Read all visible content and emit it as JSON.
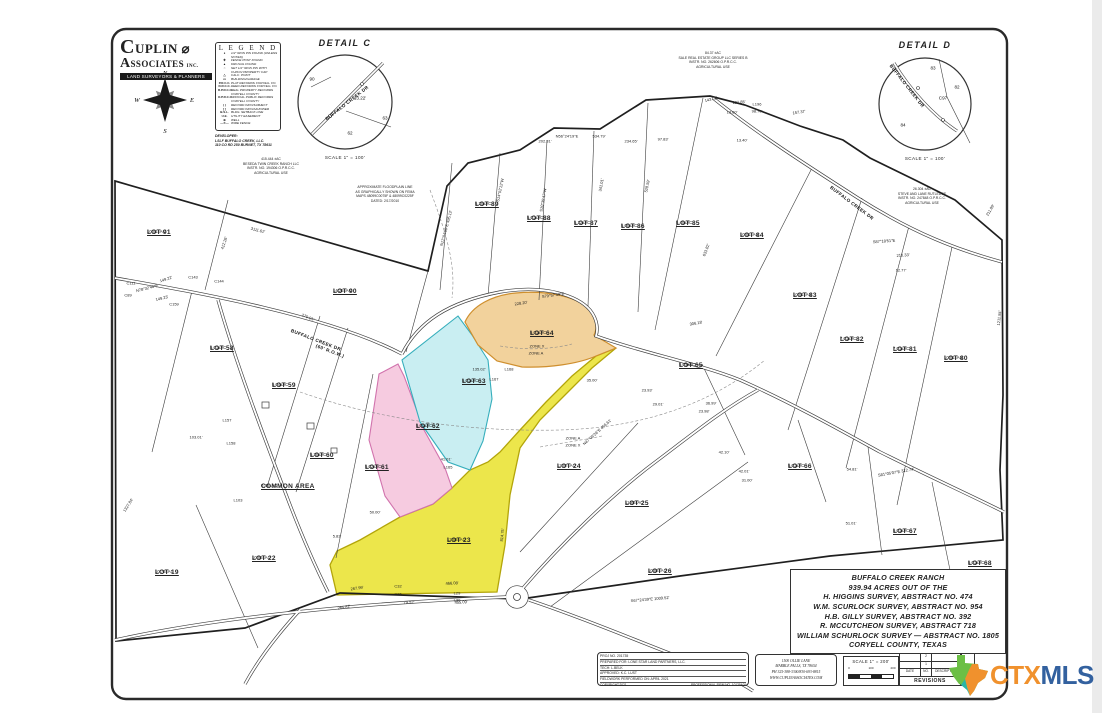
{
  "branding": {
    "name_top": "CUPLIN",
    "name_mid": "ASSOCIATES",
    "name_inc": "INC.",
    "banner": "LAND SURVEYORS & PLANNERS"
  },
  "compass": {
    "n": "N",
    "e": "E",
    "s": "S",
    "w": "W"
  },
  "legend": {
    "title": "L E G E N D",
    "items": [
      {
        "sym": "●",
        "text": "1/2\" IRON PIN FOUND (UNLESS NOTED)"
      },
      {
        "sym": "✚",
        "text": "FENCE POST FOUND"
      },
      {
        "sym": "▲",
        "text": "60D NAIL FOUND"
      },
      {
        "sym": "○",
        "text": "SET 1/2\" IRON PIN WITH CUPLIN PROPERTY CAP"
      },
      {
        "sym": "△",
        "text": "CALC. POINT"
      },
      {
        "sym": "▭",
        "text": "BUILDING/GARAGE"
      },
      {
        "sym": "P.R.C.C.",
        "text": "PLAT RECORDS CORYELL CO."
      },
      {
        "sym": "D.R.C.C.",
        "text": "DEED RECORDS CORYELL CO."
      },
      {
        "sym": "R.P.R.C.C.",
        "text": "REAL PROPERTY RECORDS CORYELL COUNTY"
      },
      {
        "sym": "O.P.R.C.C.",
        "text": "OFFICIAL PUBLIC RECORDS CORYELL COUNTY"
      },
      {
        "sym": "( )",
        "text": "RECORD INFO/SUBJECT"
      },
      {
        "sym": "[ ]",
        "text": "RECORD INFO/ADJOINER"
      },
      {
        "sym": "B.S.L.",
        "text": "BLDG. SETBACK LINE"
      },
      {
        "sym": "U.E.",
        "text": "UTILITY EASEMENT"
      },
      {
        "sym": "⊕",
        "text": "WELL"
      },
      {
        "sym": "—✕—",
        "text": "WIRE FENCE"
      }
    ]
  },
  "developer": {
    "lines": [
      "DEVELOPER:",
      "LSLF BUFFALO CREEK, LLC.",
      "110 CO RD 250 BURNET, TX 78611"
    ]
  },
  "notes": {
    "beseda": [
      "415.444  ±AC",
      "BESEDA TWIN CREEK RANCH LLC",
      "INSTR. NO. 194306 O.P.R.C.C.",
      "AGRICULTURAL USE"
    ],
    "floodplain": [
      "APPROXIMATE FLOODPLAIN LINE",
      "AS GRAPHICALLY SHOWN ON FEMA",
      "MAPS 48099C0075F & 48099C0225F",
      "DATED: 2/17/2010"
    ],
    "sale": [
      "84.37  ±AC",
      "SALE REAL ESTATE GROUP LLC SERIES B",
      "INSTR. NO. 262606 O.P.R.C.C.",
      "AGRICULTURAL USE"
    ],
    "rutledge": [
      "26.304  ±AC",
      "STEVE AND LANE RUTLEDGE",
      "INSTR. NO. 247848 O.P.R.C.C.",
      "AGRICULTURAL USE"
    ]
  },
  "detail_c": {
    "title": "DETAIL  C",
    "scale": "SCALE  1\" =  100'",
    "labels": [
      {
        "t": "90",
        "x": 312,
        "y": 79,
        "r": 0
      },
      {
        "t": "63",
        "x": 385,
        "y": 118,
        "r": 0
      },
      {
        "t": "62",
        "x": 350,
        "y": 133,
        "r": 0
      },
      {
        "t": "13.22'",
        "x": 360,
        "y": 98,
        "r": 0
      },
      {
        "t": "BUFFALO CREEK DR",
        "x": 347,
        "y": 103,
        "r": -38
      }
    ]
  },
  "detail_d": {
    "title": "DETAIL  D",
    "scale": "SCALE  1\" =  100'",
    "labels": [
      {
        "t": "83",
        "x": 933,
        "y": 68,
        "r": 0
      },
      {
        "t": "82",
        "x": 957,
        "y": 87,
        "r": 0
      },
      {
        "t": "84",
        "x": 903,
        "y": 125,
        "r": 0
      },
      {
        "t": "C97",
        "x": 943,
        "y": 98,
        "r": 0
      },
      {
        "t": "BUFFALO CREEK DR",
        "x": 907,
        "y": 86,
        "r": 52
      }
    ]
  },
  "title_block": {
    "lines": [
      "BUFFALO CREEK RANCH",
      "939.94 ACRES OUT OF THE",
      "H. HIGGINS SURVEY, ABSTRACT NO. 474",
      "W.M. SCURLOCK SURVEY, ABSTRACT NO. 954",
      "H.B. GILLY SURVEY, ABSTRACT NO. 392",
      "R. MCCUTCHEON SURVEY, ABSTRACT 718",
      "WILLIAM SCHURLOCK SURVEY — ABSTRACT NO. 1805",
      "CORYELL COUNTY, TEXAS"
    ]
  },
  "proj_box": {
    "rows": [
      "PROJ NO. 201735",
      "PREPARED FOR: LONE STAR LAND PARTNERS, LLC.",
      "TECH: L.BELK",
      "APPROVED: K.C. LUST",
      "FIELDWORK PERFORMED ON: APRIL 2021"
    ],
    "copyright": "COPYRIGHT:2021",
    "firm": "PROFESSIONAL FIRM NO. 10139400"
  },
  "address_box": {
    "lines": [
      "1500 OLLIE LANE",
      "MARBLE FALLS, TX 78654",
      "PH 325-388-3300/830-693-8815",
      "WWW.CUPLINASSOCIATES.COM"
    ]
  },
  "scale_box": {
    "label": "SCALE  1\" =  200'",
    "ticks": [
      "0",
      "100",
      "200"
    ]
  },
  "revisions": {
    "rows": [
      "2",
      "1"
    ],
    "date": "DATE",
    "no": "NO.",
    "description": "DESCRIPTION",
    "label": "REVISIONS"
  },
  "sheet_box": {
    "word": "SHEET",
    "num": "7 of"
  },
  "watermark": {
    "ctx": "CTX",
    "mls": "MLS",
    "ctx_color": "#f0912d",
    "mls_color": "#33619f",
    "texas_green": "#6cbf45",
    "texas_orange": "#f0912d",
    "texas_teal": "#2ab5a5"
  },
  "map": {
    "colors": {
      "lot23_fill": "#ece64b",
      "lot23_stroke": "#b3a50a",
      "lot62_fill": "#f6cbe0",
      "lot62_stroke": "#d173ad",
      "lot63_fill": "#c9eef2",
      "lot63_stroke": "#35aebc",
      "lot64_fill": "#f2d29c",
      "lot64_stroke": "#cf8f2e"
    },
    "lots": [
      {
        "name": "LOT 91",
        "area": "10.01±AC",
        "x": 147,
        "y": 229
      },
      {
        "name": "LOT 90",
        "area": "14.25±AC",
        "x": 333,
        "y": 288
      },
      {
        "name": "LOT 89",
        "area": "5.20±AC",
        "x": 475,
        "y": 201
      },
      {
        "name": "LOT 88",
        "area": "5.01±AC",
        "x": 527,
        "y": 215
      },
      {
        "name": "LOT 87",
        "area": "5.12±AC",
        "x": 574,
        "y": 220
      },
      {
        "name": "LOT 86",
        "area": "5.00±AC",
        "x": 621,
        "y": 223
      },
      {
        "name": "LOT 85",
        "area": "5.40±AC",
        "x": 676,
        "y": 220
      },
      {
        "name": "LOT 84",
        "area": "10.01±AC",
        "x": 740,
        "y": 232
      },
      {
        "name": "LOT 83",
        "area": "10.01±AC",
        "x": 793,
        "y": 292
      },
      {
        "name": "LOT 82",
        "area": "7.01±AC",
        "x": 840,
        "y": 336
      },
      {
        "name": "LOT 81",
        "area": "7.01±AC",
        "x": 893,
        "y": 346
      },
      {
        "name": "LOT 80",
        "area": "10.01±AC",
        "x": 944,
        "y": 355
      },
      {
        "name": "LOT 58",
        "area": "5.01±AC",
        "x": 210,
        "y": 345
      },
      {
        "name": "LOT 59",
        "area": "5.04±AC",
        "x": 272,
        "y": 382
      },
      {
        "name": "LOT 60",
        "area": "5.30±AC",
        "x": 310,
        "y": 452
      },
      {
        "name": "LOT 61",
        "area": "5.02±AC",
        "x": 365,
        "y": 464
      },
      {
        "name": "LOT 62",
        "area": "5.01±AC",
        "x": 416,
        "y": 423
      },
      {
        "name": "LOT 63",
        "area": "5.01±AC",
        "x": 462,
        "y": 378
      },
      {
        "name": "LOT 64",
        "area": "5.01±AC",
        "x": 530,
        "y": 330
      },
      {
        "name": "LOT 65",
        "area": "5.01±AC",
        "x": 679,
        "y": 362
      },
      {
        "name": "LOT 66",
        "area": "5.01±AC",
        "x": 788,
        "y": 463
      },
      {
        "name": "LOT 67",
        "area": "5.01±AC",
        "x": 893,
        "y": 528
      },
      {
        "name": "LOT 68",
        "area": "5.01±AC",
        "x": 968,
        "y": 560
      },
      {
        "name": "LOT 22",
        "area": "10.06±AC",
        "x": 252,
        "y": 555
      },
      {
        "name": "LOT 19",
        "area": "10.73±AC",
        "x": 155,
        "y": 569
      },
      {
        "name": "LOT 23",
        "area": "12.08±AC",
        "x": 447,
        "y": 537
      },
      {
        "name": "LOT 24",
        "area": "12.07±AC",
        "x": 557,
        "y": 463
      },
      {
        "name": "LOT 25",
        "area": "11.80±AC",
        "x": 625,
        "y": 500
      },
      {
        "name": "LOT 26",
        "area": "10.02±AC",
        "x": 648,
        "y": 568
      },
      {
        "name": "COMMON AREA",
        "area": "0.80±AC",
        "x": 261,
        "y": 483
      }
    ],
    "road_names": [
      {
        "t": "BUFFALO CREEK DR",
        "x": 316,
        "y": 340,
        "r": 21
      },
      {
        "t": "(60' R.O.W.)",
        "x": 330,
        "y": 351,
        "r": 21
      },
      {
        "t": "BUFFALO CREEK DR",
        "x": 852,
        "y": 203,
        "r": 37
      }
    ],
    "measurements": [
      {
        "t": "3111.62'",
        "x": 258,
        "y": 230,
        "r": 14
      },
      {
        "t": "N17°04'50\"E  495.12'",
        "x": 446,
        "y": 228,
        "r": -75
      },
      {
        "t": "412.26'",
        "x": 224,
        "y": 243,
        "r": -72
      },
      {
        "t": "149.22'",
        "x": 166,
        "y": 279,
        "r": -18
      },
      {
        "t": "N78°32'40\"E",
        "x": 147,
        "y": 288,
        "r": -14
      },
      {
        "t": "149.23'",
        "x": 162,
        "y": 298,
        "r": -14
      },
      {
        "t": "C143",
        "x": 193,
        "y": 277,
        "r": 0
      },
      {
        "t": "C144",
        "x": 219,
        "y": 281,
        "r": 0
      },
      {
        "t": "C159",
        "x": 174,
        "y": 304,
        "r": 0
      },
      {
        "t": "C111",
        "x": 131,
        "y": 283,
        "r": 0
      },
      {
        "t": "C89",
        "x": 128,
        "y": 295,
        "r": 0
      },
      {
        "t": "103.01'",
        "x": 196,
        "y": 437,
        "r": 0
      },
      {
        "t": "L157",
        "x": 227,
        "y": 420,
        "r": 0
      },
      {
        "t": "L158",
        "x": 231,
        "y": 443,
        "r": 0
      },
      {
        "t": "L103",
        "x": 238,
        "y": 500,
        "r": 0
      },
      {
        "t": "270.01'",
        "x": 308,
        "y": 317,
        "r": 22
      },
      {
        "t": "1327.84'",
        "x": 128,
        "y": 505,
        "r": -58
      },
      {
        "t": "S14°02'12\"W",
        "x": 500,
        "y": 190,
        "r": -78
      },
      {
        "t": "S10°35'47\"W",
        "x": 543,
        "y": 200,
        "r": -80
      },
      {
        "t": "341.01'",
        "x": 601,
        "y": 185,
        "r": -80
      },
      {
        "t": "528.59'",
        "x": 647,
        "y": 186,
        "r": -78
      },
      {
        "t": "N56°24'19\"E",
        "x": 567,
        "y": 136,
        "r": 0
      },
      {
        "t": "534.79'",
        "x": 599,
        "y": 136,
        "r": 0
      },
      {
        "t": "234.65'",
        "x": 631,
        "y": 141,
        "r": 0
      },
      {
        "t": "202.31'",
        "x": 545,
        "y": 141,
        "r": 0
      },
      {
        "t": "97.83'",
        "x": 663,
        "y": 139,
        "r": 0
      },
      {
        "t": "13.40'",
        "x": 742,
        "y": 140,
        "r": 0
      },
      {
        "t": "143.02'",
        "x": 711,
        "y": 99,
        "r": -15
      },
      {
        "t": "131.85'",
        "x": 739,
        "y": 102,
        "r": -5
      },
      {
        "t": "L196",
        "x": 757,
        "y": 104,
        "r": 0
      },
      {
        "t": "98.70'",
        "x": 757,
        "y": 111,
        "r": 0
      },
      {
        "t": "157.37'",
        "x": 799,
        "y": 112,
        "r": -8
      },
      {
        "t": "13.60'",
        "x": 732,
        "y": 112,
        "r": 0
      },
      {
        "t": "S87°18'51\"E",
        "x": 884,
        "y": 241,
        "r": -4
      },
      {
        "t": "210.33'",
        "x": 903,
        "y": 255,
        "r": -4
      },
      {
        "t": "12.77'",
        "x": 901,
        "y": 270,
        "r": 0
      },
      {
        "t": "633.82'",
        "x": 706,
        "y": 250,
        "r": -70
      },
      {
        "t": "211.89'",
        "x": 990,
        "y": 210,
        "r": -60
      },
      {
        "t": "1211.84'",
        "x": 999,
        "y": 318,
        "r": -84
      },
      {
        "t": "S81°05'07\"E  312.74'",
        "x": 896,
        "y": 472,
        "r": -10
      },
      {
        "t": "51.01'",
        "x": 851,
        "y": 523,
        "r": 0
      },
      {
        "t": "54.81'",
        "x": 852,
        "y": 469,
        "r": 0
      },
      {
        "t": "306.18'",
        "x": 696,
        "y": 323,
        "r": -10
      },
      {
        "t": "23.93'",
        "x": 647,
        "y": 390,
        "r": 0
      },
      {
        "t": "29.01'",
        "x": 658,
        "y": 404,
        "r": 0
      },
      {
        "t": "36.99'",
        "x": 711,
        "y": 403,
        "r": 0
      },
      {
        "t": "23.98'",
        "x": 704,
        "y": 411,
        "r": 0
      },
      {
        "t": "42.10'",
        "x": 724,
        "y": 452,
        "r": 0
      },
      {
        "t": "42.01'",
        "x": 744,
        "y": 471,
        "r": 0
      },
      {
        "t": "31.00'",
        "x": 747,
        "y": 480,
        "r": 0
      },
      {
        "t": "35.00'",
        "x": 592,
        "y": 380,
        "r": 0
      },
      {
        "t": "135.02'",
        "x": 479,
        "y": 369,
        "r": 0
      },
      {
        "t": "L167",
        "x": 494,
        "y": 379,
        "r": 0
      },
      {
        "t": "L168",
        "x": 509,
        "y": 369,
        "r": 0
      },
      {
        "t": "228.20'",
        "x": 521,
        "y": 303,
        "r": -8
      },
      {
        "t": "S79°57'49\"E",
        "x": 553,
        "y": 295,
        "r": -8
      },
      {
        "t": "41.01'",
        "x": 446,
        "y": 459,
        "r": 0
      },
      {
        "t": "L165",
        "x": 448,
        "y": 467,
        "r": 0
      },
      {
        "t": "50.00'",
        "x": 375,
        "y": 512,
        "r": 0
      },
      {
        "t": "5.83'",
        "x": 337,
        "y": 536,
        "r": 0
      },
      {
        "t": "267.99'",
        "x": 357,
        "y": 588,
        "r": -8
      },
      {
        "t": "C32",
        "x": 398,
        "y": 586,
        "r": 0
      },
      {
        "t": "C36",
        "x": 398,
        "y": 594,
        "r": 0
      },
      {
        "t": "L29",
        "x": 457,
        "y": 593,
        "r": 0
      },
      {
        "t": "L30",
        "x": 457,
        "y": 600,
        "r": 0
      },
      {
        "t": "466.08'",
        "x": 452,
        "y": 583,
        "r": -3
      },
      {
        "t": "455.09'",
        "x": 461,
        "y": 602,
        "r": -3
      },
      {
        "t": "79.52'",
        "x": 409,
        "y": 602,
        "r": 0
      },
      {
        "t": "265.82'",
        "x": 344,
        "y": 607,
        "r": -10
      },
      {
        "t": "814.75'",
        "x": 502,
        "y": 535,
        "r": -83
      },
      {
        "t": "S67°24'39\"E  1009.52'",
        "x": 650,
        "y": 599,
        "r": -5
      },
      {
        "t": "N47°06'26\"E  456.61'",
        "x": 597,
        "y": 432,
        "r": -42
      },
      {
        "t": "ZONE X",
        "x": 537,
        "y": 346,
        "r": 0
      },
      {
        "t": "ZONE A",
        "x": 536,
        "y": 353,
        "r": 0
      },
      {
        "t": "ZONE A",
        "x": 573,
        "y": 438,
        "r": 0
      },
      {
        "t": "ZONE X",
        "x": 573,
        "y": 445,
        "r": 0
      }
    ]
  }
}
